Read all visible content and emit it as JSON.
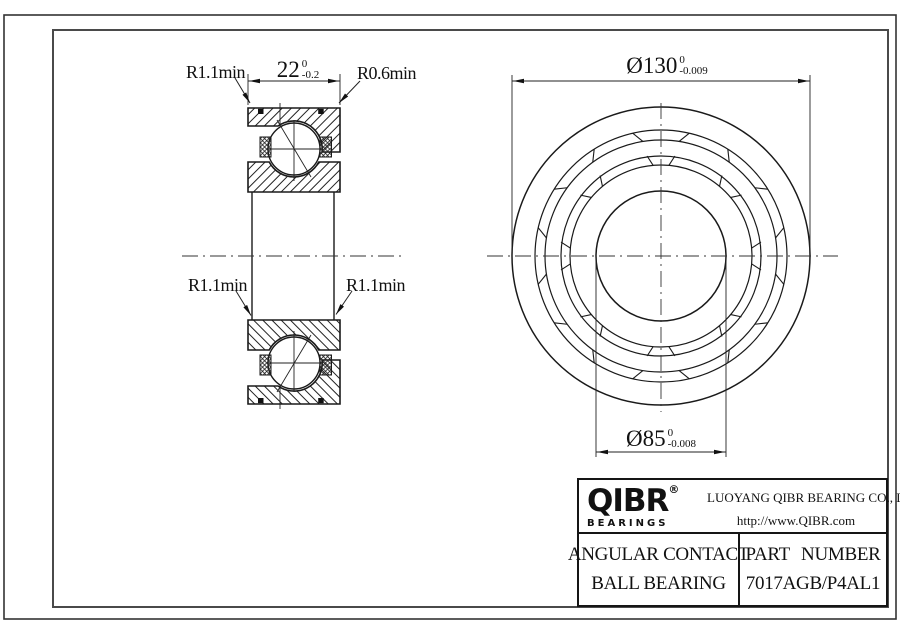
{
  "sheet": {
    "annotations": {
      "r_top_left": "R1.1min",
      "r_top_right": "R0.6min",
      "r_bottom_left": "R1.1min",
      "r_bottom_right": "R1.1min"
    },
    "dimensions": {
      "width": {
        "value": "22",
        "tol_upper": "0",
        "tol_lower": "-0.2"
      },
      "outer_diameter": {
        "value": "Ø130",
        "tol_upper": "0",
        "tol_lower": "-0.009"
      },
      "bore_diameter": {
        "value": "Ø85",
        "tol_upper": "0",
        "tol_lower": "-0.008"
      }
    },
    "title_block": {
      "brand": "QIBR",
      "registered": "®",
      "brand_sub": "BEARINGS",
      "company": "LUOYANG QIBR BEARING CO., LTD",
      "website": "http://www.QIBR.com",
      "product_line1": "ANGULAR CONTACT",
      "product_line2": "BALL BEARING",
      "part_number_label": "PART NUMBER",
      "part_number": "7017AGB/P4AL1"
    },
    "colors": {
      "line": "#1a1a1a",
      "frame": "#4a4a4a",
      "background": "#ffffff"
    }
  }
}
